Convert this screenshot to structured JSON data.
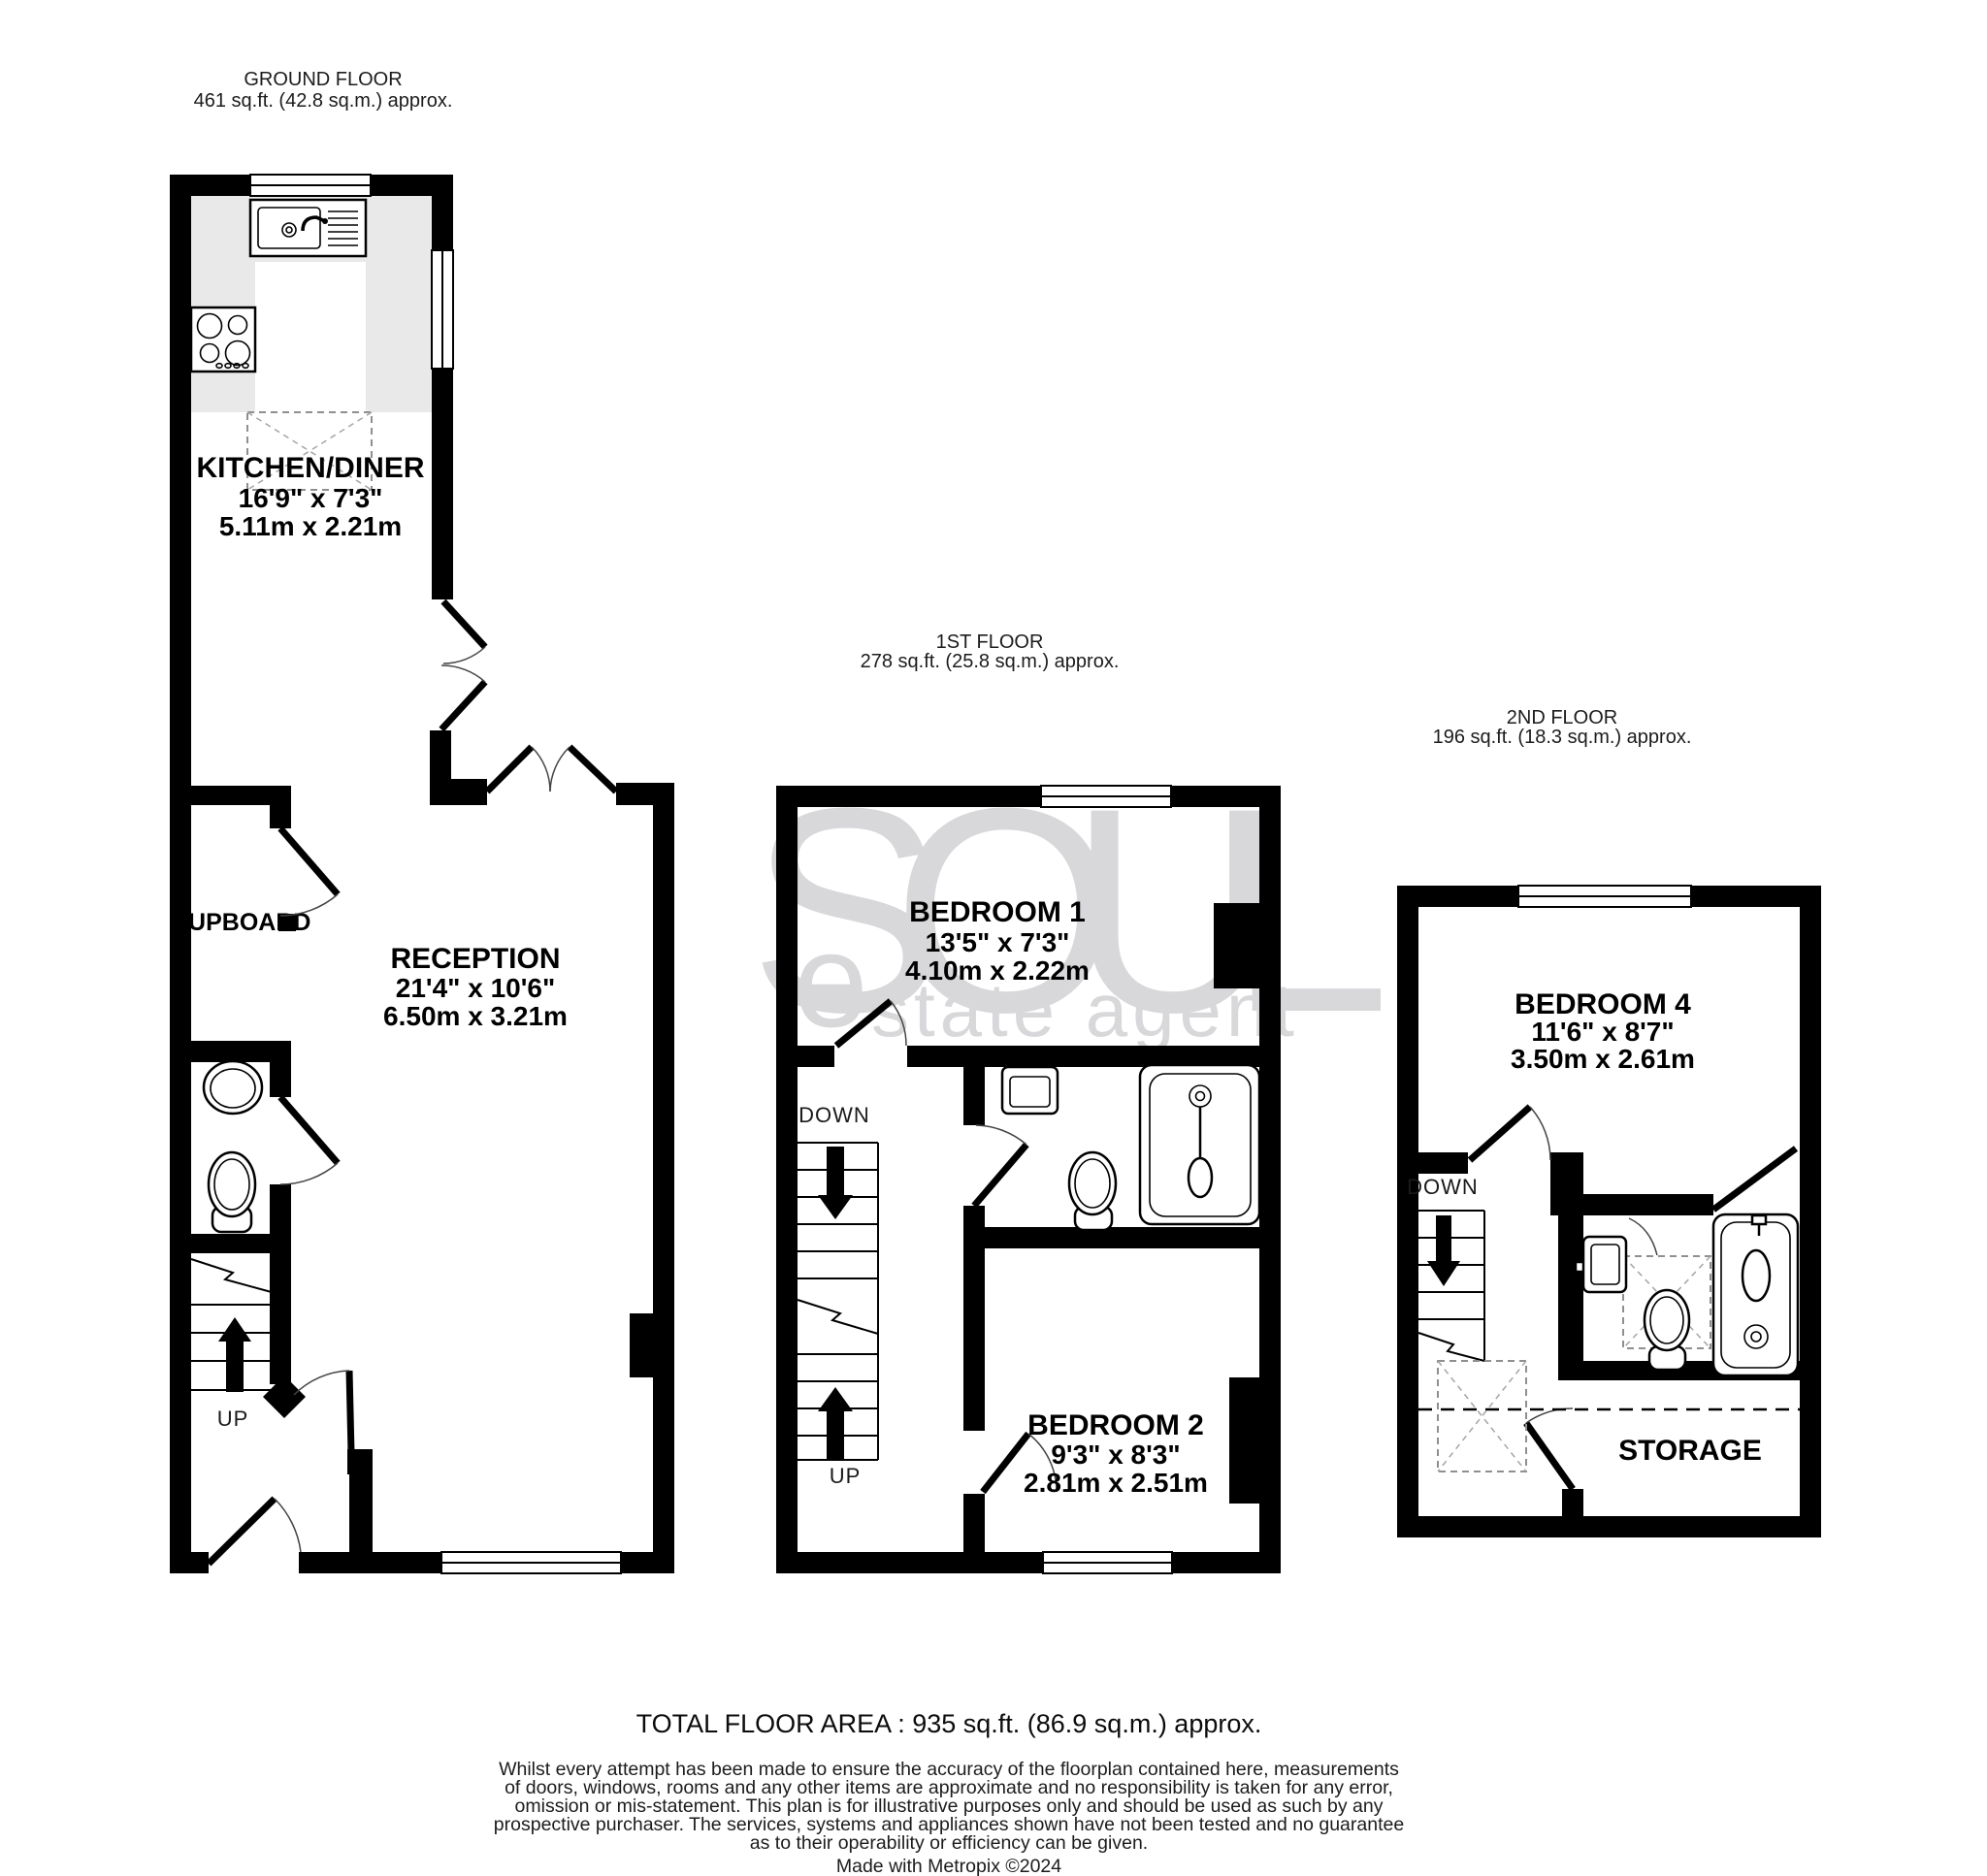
{
  "ground": {
    "title": "GROUND FLOOR",
    "area": "461 sq.ft. (42.8 sq.m.) approx.",
    "kitchen": {
      "name": "KITCHEN/DINER",
      "imperial": "16'9\" x 7'3\"",
      "metric": "5.11m x 2.21m"
    },
    "reception": {
      "name": "RECEPTION",
      "imperial": "21'4\" x 10'6\"",
      "metric": "6.50m x 3.21m"
    },
    "cupboard": "CUPBOARD",
    "up": "UP"
  },
  "first": {
    "title": "1ST FLOOR",
    "area": "278 sq.ft. (25.8 sq.m.) approx.",
    "bedroom1": {
      "name": "BEDROOM 1",
      "imperial": "13'5\" x 7'3\"",
      "metric": "4.10m x 2.22m"
    },
    "bedroom2": {
      "name": "BEDROOM 2",
      "imperial": "9'3\" x 8'3\"",
      "metric": "2.81m x 2.51m"
    },
    "down": "DOWN",
    "up": "UP"
  },
  "second": {
    "title": "2ND FLOOR",
    "area": "196 sq.ft. (18.3 sq.m.) approx.",
    "bedroom4": {
      "name": "BEDROOM 4",
      "imperial": "11'6\" x 8'7\"",
      "metric": "3.50m x 2.61m"
    },
    "storage": "STORAGE",
    "down": "DOWN"
  },
  "watermark": {
    "brand": "SOUL",
    "accent": "e",
    "tagline": "state agent",
    "color": "#d8d8db"
  },
  "footer": {
    "total": "TOTAL FLOOR AREA : 935 sq.ft. (86.9 sq.m.) approx.",
    "disclaimer": [
      "Whilst every attempt has been made to ensure the accuracy of the floorplan contained here, measurements",
      "of doors, windows, rooms and any other items are approximate and no responsibility is taken for any error,",
      "omission or mis-statement. This plan is for illustrative purposes only and should be used as such by any",
      "prospective purchaser. The services, systems and appliances shown have not been tested and no guarantee",
      "as to their operability or efficiency can be given."
    ],
    "credit": "Made with Metropix ©2024"
  }
}
